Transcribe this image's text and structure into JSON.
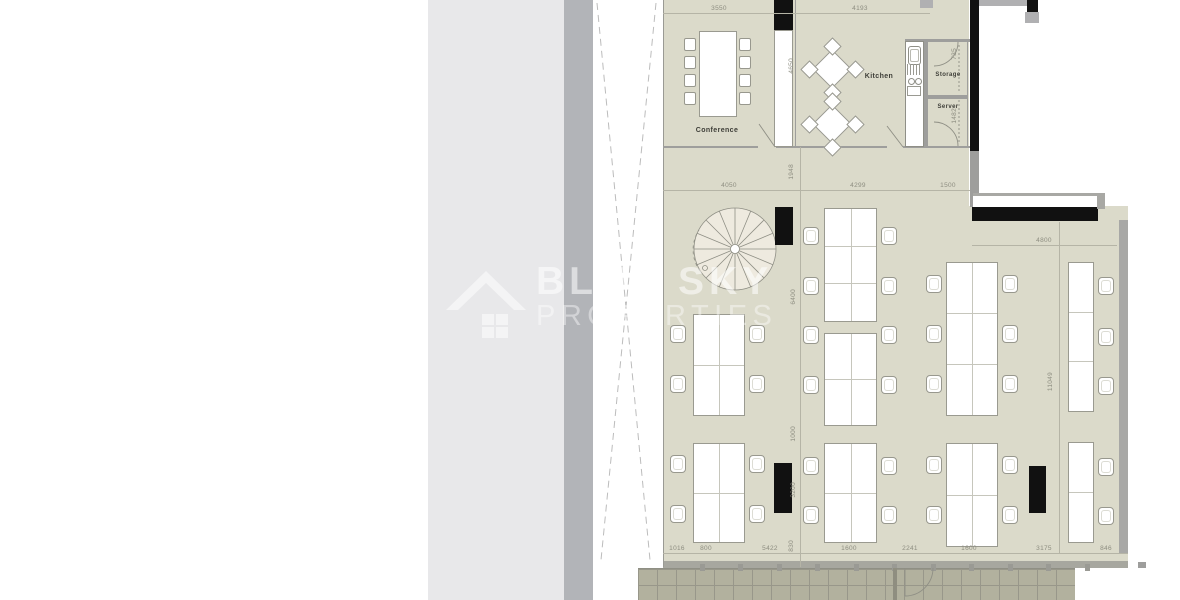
{
  "watermark": {
    "title": "BLUE SKY",
    "subtitle": "PROPERTIES",
    "logo": "house-roof-icon"
  },
  "plan": {
    "rooms": [
      {
        "label": "Conference"
      },
      {
        "label": "Kitchen"
      },
      {
        "label": "Storage"
      },
      {
        "label": "Server"
      }
    ],
    "dimensions": {
      "top": [
        "3550",
        "4193"
      ],
      "middle": [
        "4050",
        "4299",
        "1500"
      ],
      "right_width": "4800",
      "right_height": "11049",
      "left_vertical": [
        "4650",
        "1948",
        "6400",
        "1000",
        "3200",
        "830"
      ],
      "storage_door": "735",
      "server_door": "1482",
      "bottom": [
        "1016",
        "800",
        "5422",
        "1600",
        "2241",
        "1600",
        "3175",
        "846"
      ]
    }
  },
  "colors": {
    "floor": "#dbdaca",
    "deck": "#b2b19e",
    "panel_light": "#e8e8ea",
    "panel_dark": "#b2b4b8",
    "wall_black": "#111111",
    "wall_gray": "#9e9e9c",
    "dim_text": "#8d8d80"
  }
}
